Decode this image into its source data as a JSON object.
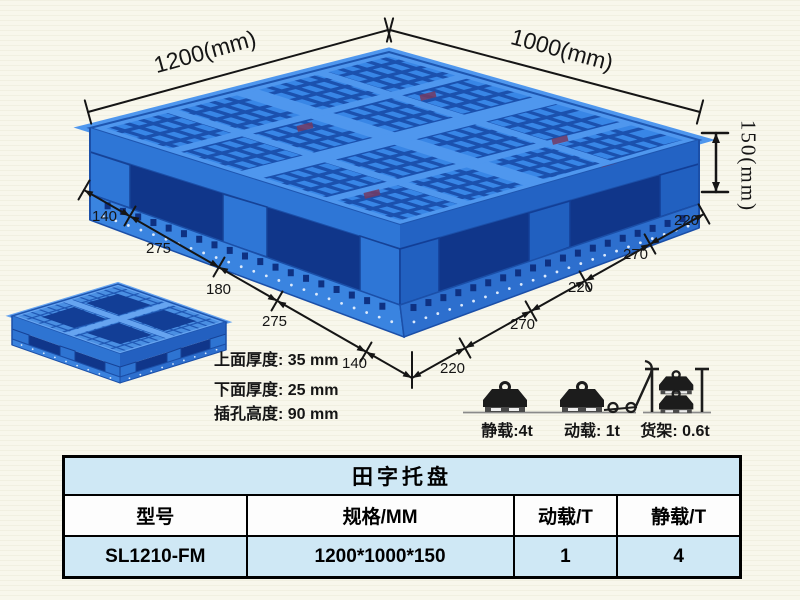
{
  "product_view": {
    "annotations": {
      "top_width": "1200(mm)",
      "top_depth": "1000(mm)",
      "side_height": "150(mm)",
      "left_chain": [
        "140",
        "275",
        "180",
        "275",
        "140"
      ],
      "right_chain": [
        "220",
        "270",
        "220",
        "270",
        "220"
      ],
      "thickness_lines": [
        "上面厚度: 35 mm",
        "下面厚度: 25 mm",
        "插孔高度: 90 mm"
      ]
    },
    "load_ratings": [
      {
        "icon": "static-load-icon",
        "label": "静载:4t"
      },
      {
        "icon": "dynamic-load-icon",
        "label": "动载: 1t"
      },
      {
        "icon": "rack-load-icon",
        "label": "货架: 0.6t"
      }
    ]
  },
  "table": {
    "title": "田字托盘",
    "columns": [
      "型号",
      "规格/MM",
      "动载/T",
      "静载/T"
    ],
    "rows": [
      [
        "SL1210-FM",
        "1200*1000*150",
        "1",
        "4"
      ]
    ]
  },
  "colors": {
    "pallet_blue": "#3886e6",
    "pallet_dark_blue": "#10368a",
    "table_row_blue": "#cfe8f5",
    "background": "#f8f7ec",
    "line_black": "#151515"
  }
}
